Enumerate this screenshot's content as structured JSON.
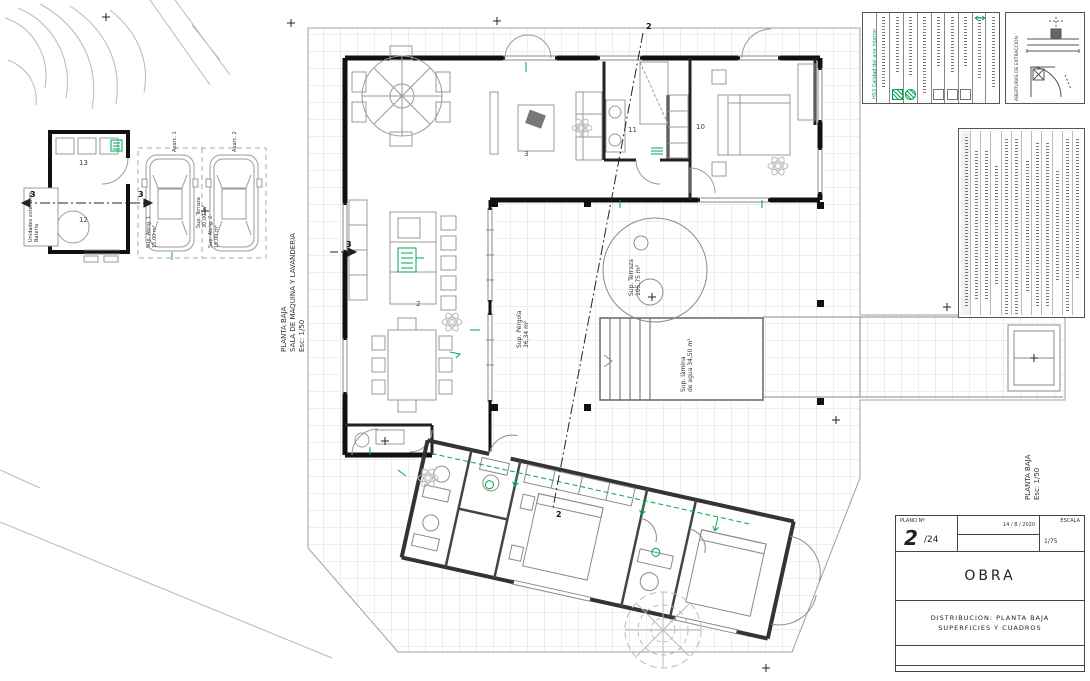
{
  "sheet": {
    "type": "architectural floor plan",
    "accent_green": "#00a651",
    "wall_color": "#111111",
    "grid_color": "#dcdcdc"
  },
  "plan_titles": {
    "machine_room": {
      "line1": "PLANTA BAJA",
      "line2": "SALA DE MAQUINA Y LAVANDERIA",
      "scale": "Esc: 1/50"
    },
    "main": {
      "line1": "PLANTA BAJA",
      "scale": "Esc: 1/50"
    },
    "exterior_units": {
      "line1": "Unidades exteriores",
      "line2": "Batería"
    }
  },
  "areas": {
    "terraza": {
      "label": "Sup. Terraza",
      "value": "105,75 m²"
    },
    "pergola": {
      "label": "Sup. Pérgola",
      "value": "36,34 m²"
    },
    "lamina_agua": {
      "label": "Sup. lámina",
      "value": "de agua 34,50 m²"
    },
    "carport_terraza": {
      "label": "Sup. Terraza",
      "value": "30,00 m²"
    },
    "abrigo1": {
      "label": "Sup. Abrig. 1",
      "value": "15,00 m²"
    },
    "abrigo2": {
      "label": "Sup. Abrig. 2",
      "value": "15,00 m²"
    },
    "aparc1": "Aparc. 1",
    "aparc2": "Aparc. 2"
  },
  "rooms": {
    "r2": {
      "num": "2"
    },
    "r3": {
      "num": "3"
    },
    "r10": {
      "num": "10"
    },
    "r11": {
      "num": "11"
    },
    "r12": {
      "num": "12"
    },
    "r13": {
      "num": "13"
    }
  },
  "sections": {
    "s2": "2",
    "s3": "3"
  },
  "panels": {
    "legend_title": "HS3 Calidad del aire interior",
    "extraction_title": "ABERTURAS DE EXTRACCION"
  },
  "titleblock": {
    "plano_label": "PLANO Nº",
    "plano_num": "2",
    "plano_total": "/24",
    "date": "14 / 8 / 2020",
    "escala_label": "ESCALA",
    "escala_value": "1/75",
    "obra": "OBRA",
    "dist_line1": "DISTRIBUCION: PLANTA BAJA",
    "dist_line2": "SUPERFICIES Y CUADROS"
  }
}
